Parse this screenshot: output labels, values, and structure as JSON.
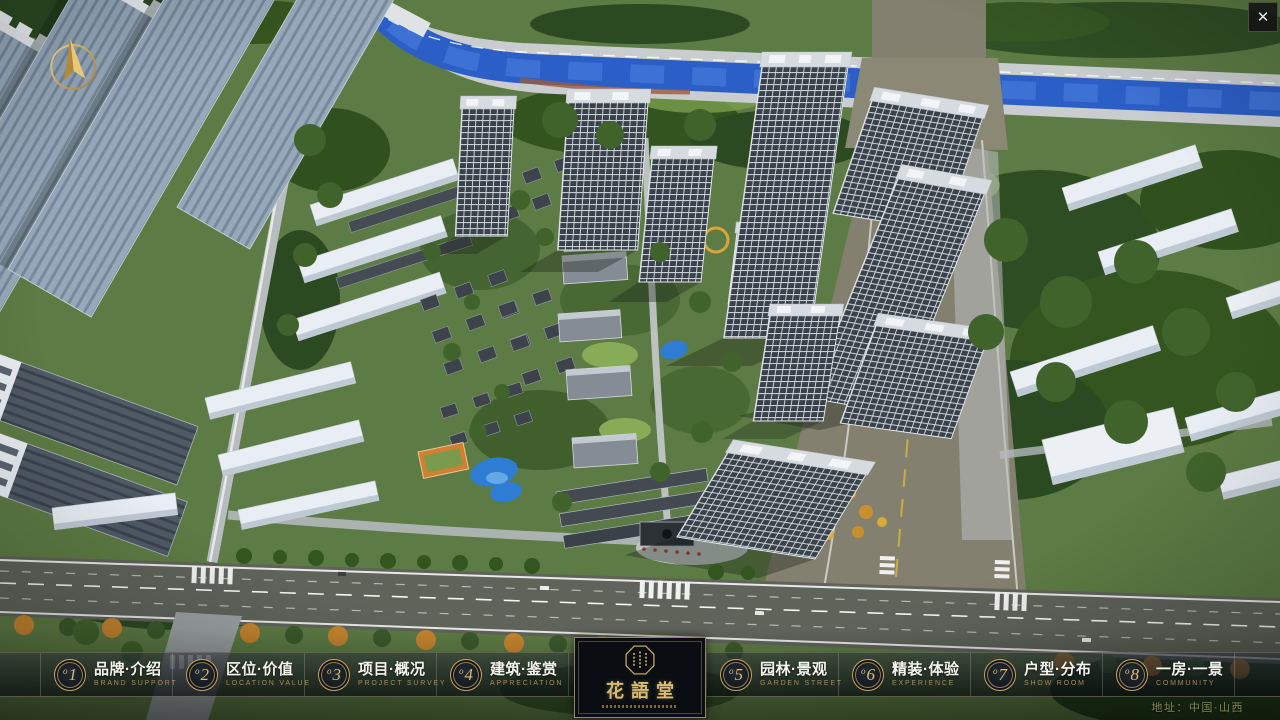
{
  "window": {
    "close_icon": "✕"
  },
  "colors": {
    "gold_accent": "#c9a25e",
    "gold_text_dim": "#a58d55",
    "bar_background": "rgba(8,12,16,0.68)",
    "river_blue": "#2b5ec6",
    "address_olive": "#84864c"
  },
  "nav": {
    "items": [
      {
        "badge_prefix": "o",
        "badge_number": "1",
        "title_zh": "品牌·介绍",
        "subtitle_en": "BRAND SUPPORT"
      },
      {
        "badge_prefix": "o",
        "badge_number": "2",
        "title_zh": "区位·价值",
        "subtitle_en": "LOCATION VALUE"
      },
      {
        "badge_prefix": "o",
        "badge_number": "3",
        "title_zh": "项目·概况",
        "subtitle_en": "PROJECT SURVEY"
      },
      {
        "badge_prefix": "o",
        "badge_number": "4",
        "title_zh": "建筑·鉴赏",
        "subtitle_en": "APPRECIATION"
      },
      {
        "badge_prefix": "o",
        "badge_number": "5",
        "title_zh": "园林·景观",
        "subtitle_en": "GARDEN STREET"
      },
      {
        "badge_prefix": "o",
        "badge_number": "6",
        "title_zh": "精装·体验",
        "subtitle_en": "EXPERIENCE"
      },
      {
        "badge_prefix": "o",
        "badge_number": "7",
        "title_zh": "户型·分布",
        "subtitle_en": "SHOW ROOM"
      },
      {
        "badge_prefix": "o",
        "badge_number": "8",
        "title_zh": "一房·一景",
        "subtitle_en": "COMMUNITY"
      }
    ]
  },
  "logo": {
    "title_zh": "花語堂"
  },
  "footer": {
    "address": "地址：中国·山西"
  }
}
